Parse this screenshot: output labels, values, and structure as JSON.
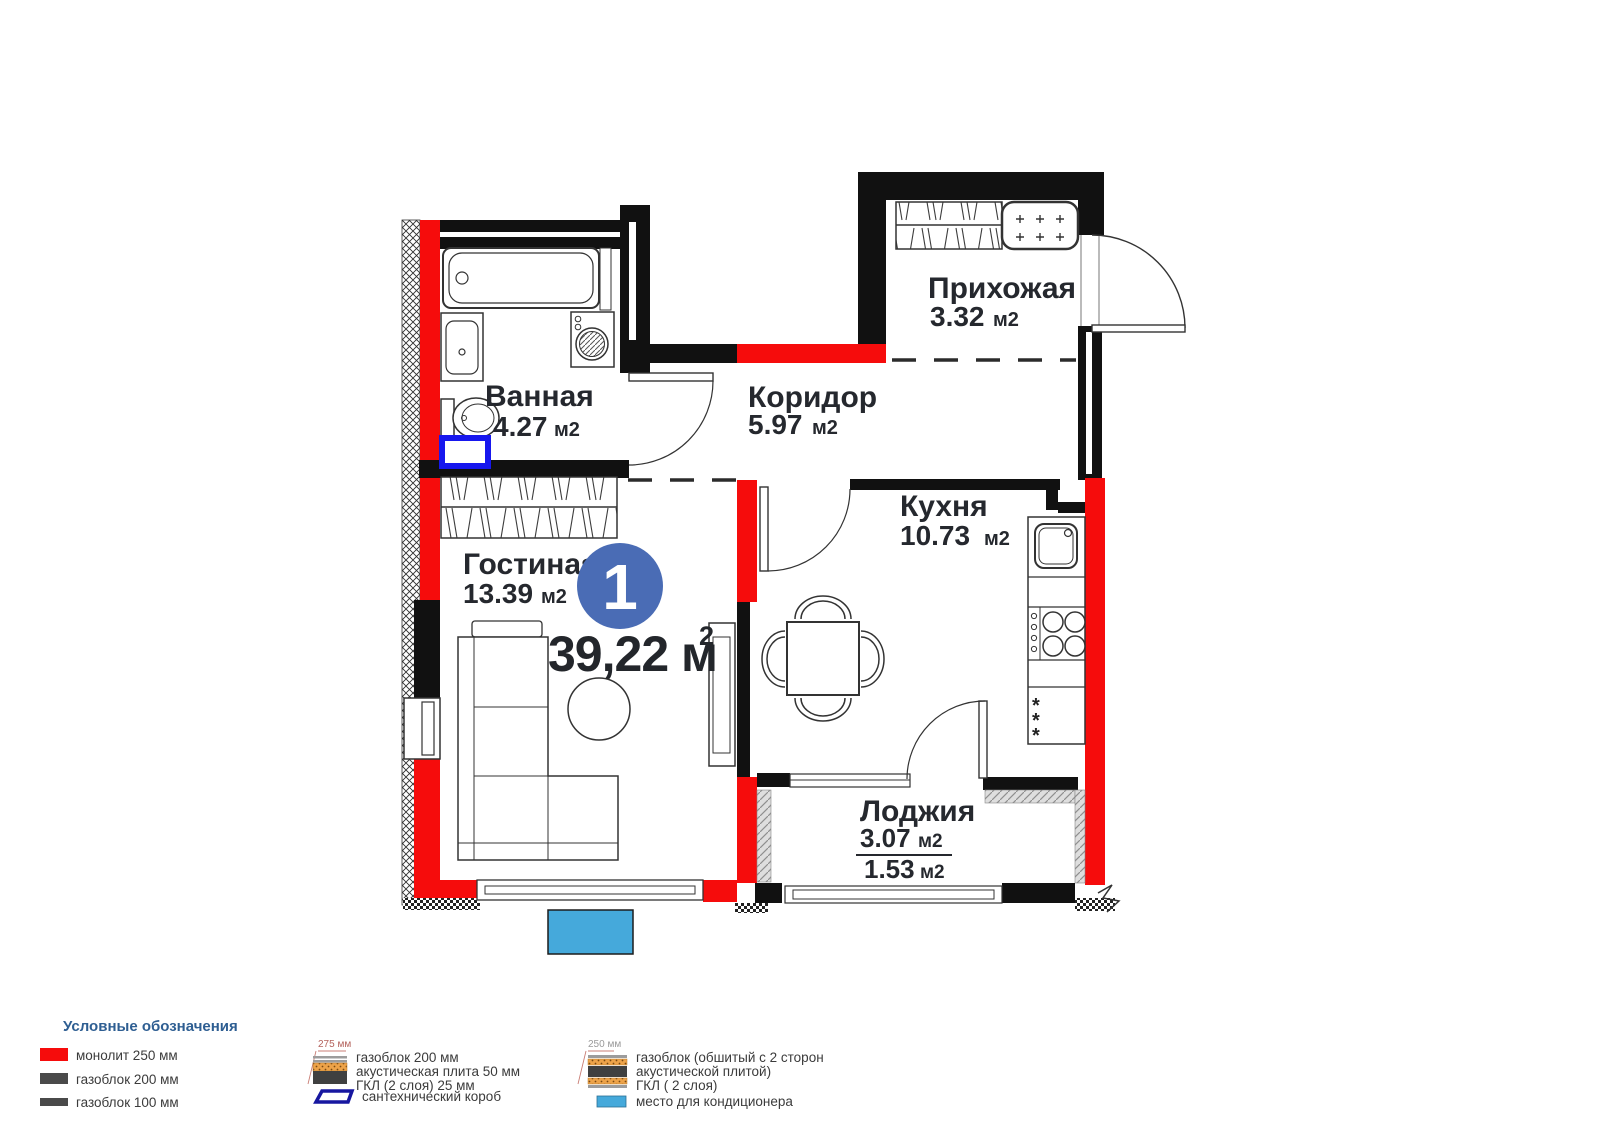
{
  "plan": {
    "badge": "1",
    "total_area": "39,22 м",
    "total_area_sup": "2",
    "fridge_marks": [
      "*",
      "*",
      "*"
    ],
    "rooms": {
      "hallway": {
        "name": "Прихожая",
        "area": "3.32",
        "unit": "м2"
      },
      "corridor": {
        "name": "Коридор",
        "area": "5.97",
        "unit": "м2"
      },
      "bathroom": {
        "name": "Ванная",
        "area": "4.27",
        "unit": "м2"
      },
      "kitchen": {
        "name": "Кухня",
        "area": "10.73",
        "unit": "м2"
      },
      "living": {
        "name": "Гостиная",
        "area": "13.39",
        "unit": "м2"
      },
      "loggia": {
        "name": "Лоджия",
        "area": "3.07",
        "unit": "м2",
        "area_coef": "1.53",
        "unit_coef": "м2"
      }
    }
  },
  "legend": {
    "title": "Условные обозначения",
    "monolith": "монолит 250 мм",
    "gasblock_200": "газоблок 200 мм",
    "gasblock_100": "газоблок 100 мм",
    "wall_275": {
      "dim": "275 мм",
      "line1": "газоблок 200 мм",
      "line2": "акустическая плита 50 мм",
      "line3": "ГКЛ (2 слоя) 25 мм"
    },
    "plumbing_box": "сантехнический короб",
    "wall_250": {
      "dim": "250 мм",
      "line1": "газоблок (обшитый с 2 сторон",
      "line2": "акустической плитой)",
      "line3": "ГКЛ ( 2 слоя)"
    },
    "ac_place": "место для кондиционера"
  },
  "colors": {
    "monolith_red": "#f60c0c",
    "wall_black": "#111111",
    "badge_blue": "#4a6cb5",
    "sanitary_blue": "#1717ee",
    "ac_blue": "#45a9db",
    "legend_title_blue": "#2e5e92",
    "acoustic_orange": "#eda349"
  }
}
